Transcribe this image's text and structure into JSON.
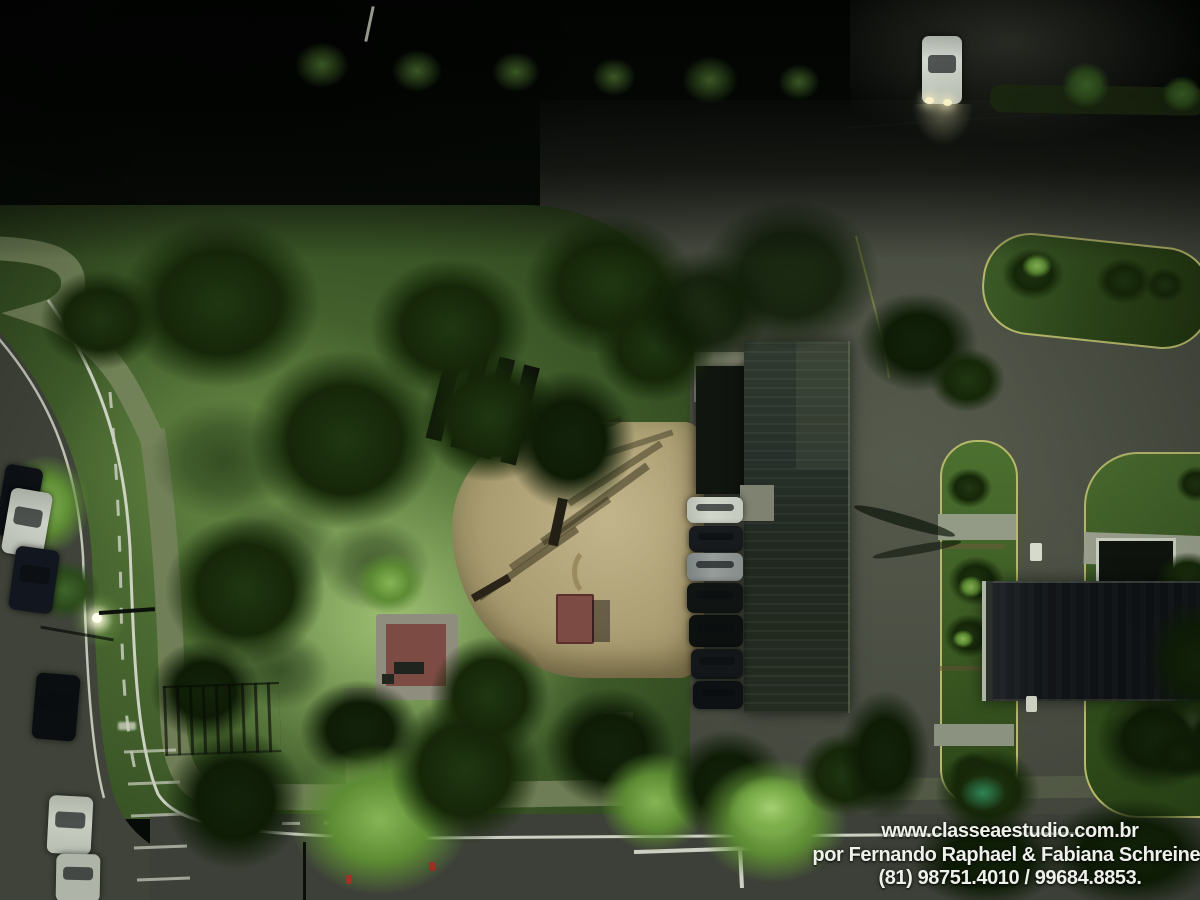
{
  "watermark": {
    "line1": "www.classeaestudio.com.br",
    "line2": "por Fernando Raphael & Fabiana Schreiner",
    "line3": "(81) 98751.4010 / 99684.8853."
  },
  "palette": {
    "night_black": "#030503",
    "pavement_gray_green": "#4a4e42",
    "road_asphalt": "#3f4339",
    "grass_bright": "#86b556",
    "grass_mid": "#5d7f3e",
    "grass_dark": "#24371a",
    "sand_playground": "#b5a77b",
    "building_roof": "#27302a",
    "flat_roof_black": "#101316",
    "curb_yellow": "#b6b86a",
    "marking_white": "#d4d8ca",
    "kiosk_red": "#7c4b43",
    "headlight_warm": "#fff7cb"
  }
}
